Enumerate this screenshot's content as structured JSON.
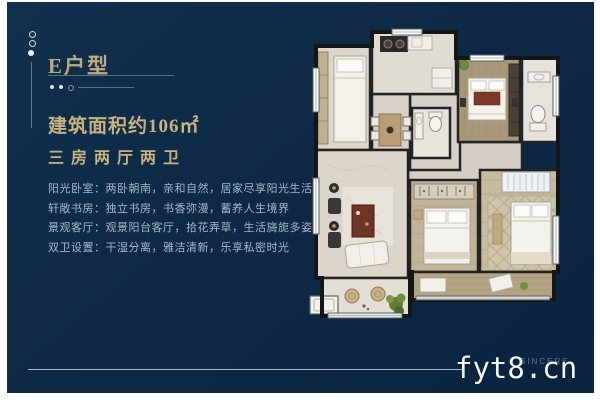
{
  "unit": {
    "title": "E户型",
    "area": "建筑面积约106㎡",
    "layout": "三房两厅两卫",
    "features": [
      "阳光卧室：两卧朝南，亲和自然，居家尽享阳光生活",
      "轩敞书房：独立书房，书香弥漫，蓄养人生境界",
      "景观客厅：观景阳台客厅，拾花弄草，生活旖旎多姿",
      "双卫设置：干湿分离，雅洁清新，乐享私密时光"
    ]
  },
  "watermark": {
    "site": "fyt8.cn",
    "brand": "SINCERE"
  },
  "colors": {
    "background_navy": "#0d2945",
    "frame_white": "#ffffff",
    "gold": "#c9b27f",
    "body_text": "#a7b7c8",
    "floor_light": "#ddd7cb",
    "floor_wood": "#a69878",
    "wall_dark": "#1d1e21",
    "plant_green": "#6f8d3d",
    "accent_red": "#7b3a29"
  }
}
